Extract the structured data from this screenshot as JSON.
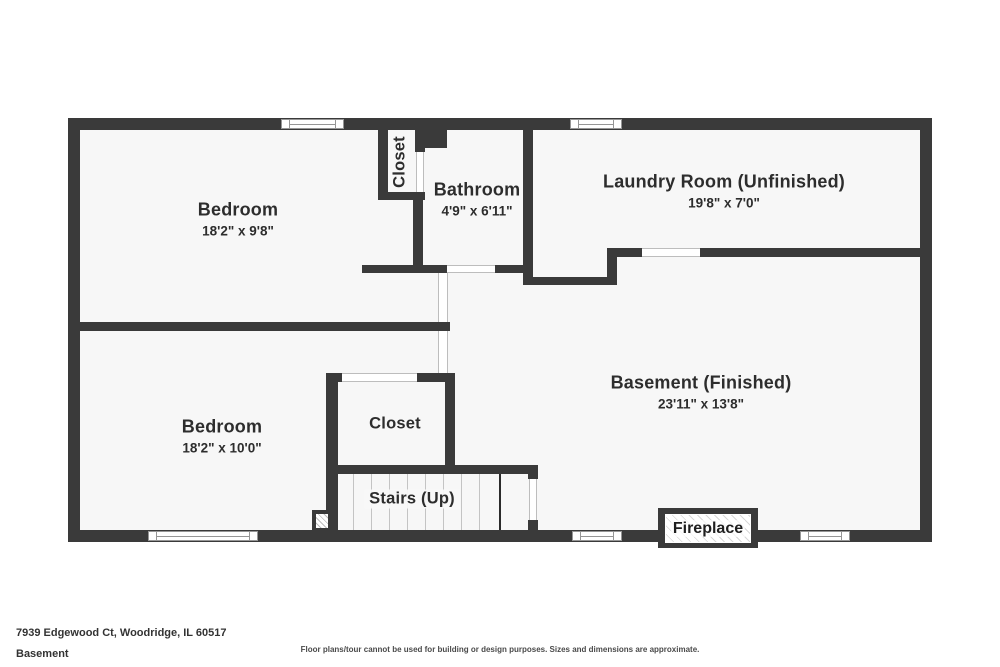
{
  "palette": {
    "wall_color": "#3a3a3a",
    "floor_color": "#f7f7f7",
    "text_color": "#2d2d2d"
  },
  "rooms": {
    "bedroom_top": {
      "name": "Bedroom",
      "dims": "18'2\" x 9'8\""
    },
    "closet_top": {
      "name": "Closet"
    },
    "bathroom": {
      "name": "Bathroom",
      "dims": "4'9\" x 6'11\""
    },
    "laundry": {
      "name": "Laundry Room (Unfinished)",
      "dims": "19'8\" x 7'0\""
    },
    "bedroom_bottom": {
      "name": "Bedroom",
      "dims": "18'2\" x 10'0\""
    },
    "closet_bottom": {
      "name": "Closet"
    },
    "basement": {
      "name": "Basement (Finished)",
      "dims": "23'11\" x 13'8\""
    },
    "stairs": {
      "name": "Stairs (Up)"
    },
    "fireplace": {
      "name": "Fireplace"
    }
  },
  "footer": {
    "address": "7939 Edgewood Ct, Woodridge, IL 60517",
    "level": "Basement",
    "disclaimer": "Floor plans/tour cannot be used for building or design purposes. Sizes and dimensions are approximate."
  }
}
